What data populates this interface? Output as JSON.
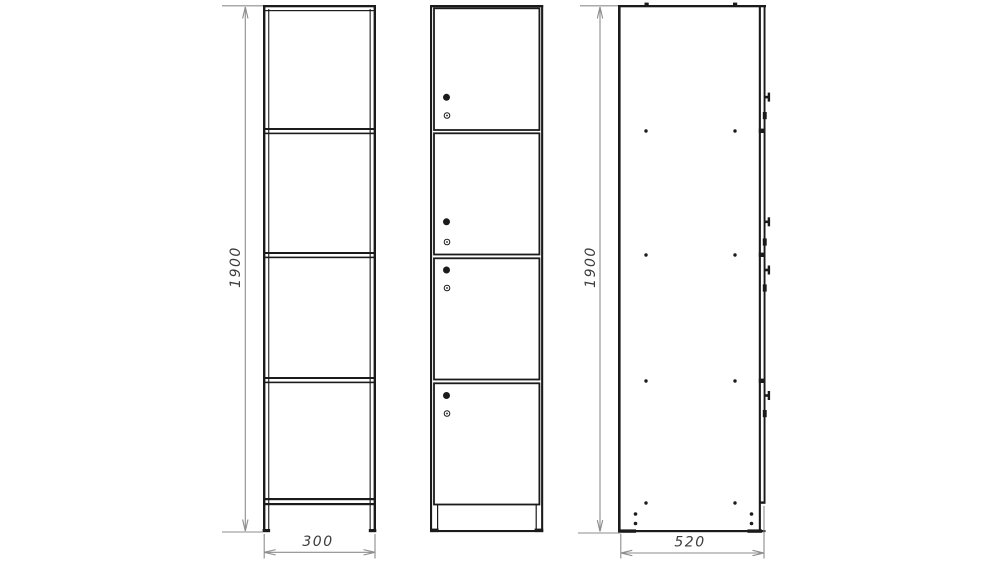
{
  "drawing": {
    "background_color": "#ffffff",
    "line_color": "#1b1b1b",
    "dimension_line_color": "#8d8d8d",
    "dimension_text_color": "#3c3c3c",
    "views": {
      "front_carcass": {
        "shelf_count": 3,
        "compartments": 4
      },
      "front_doors": {
        "door_count": 4,
        "knobs_per_door": 1,
        "locks_per_door": 1
      },
      "side": {
        "screw_rows": 4,
        "door_gap_ticks": 3
      }
    },
    "dimensions": {
      "height_front": "1900",
      "height_side": "1900",
      "width_front": "300",
      "depth_side": "520"
    }
  }
}
